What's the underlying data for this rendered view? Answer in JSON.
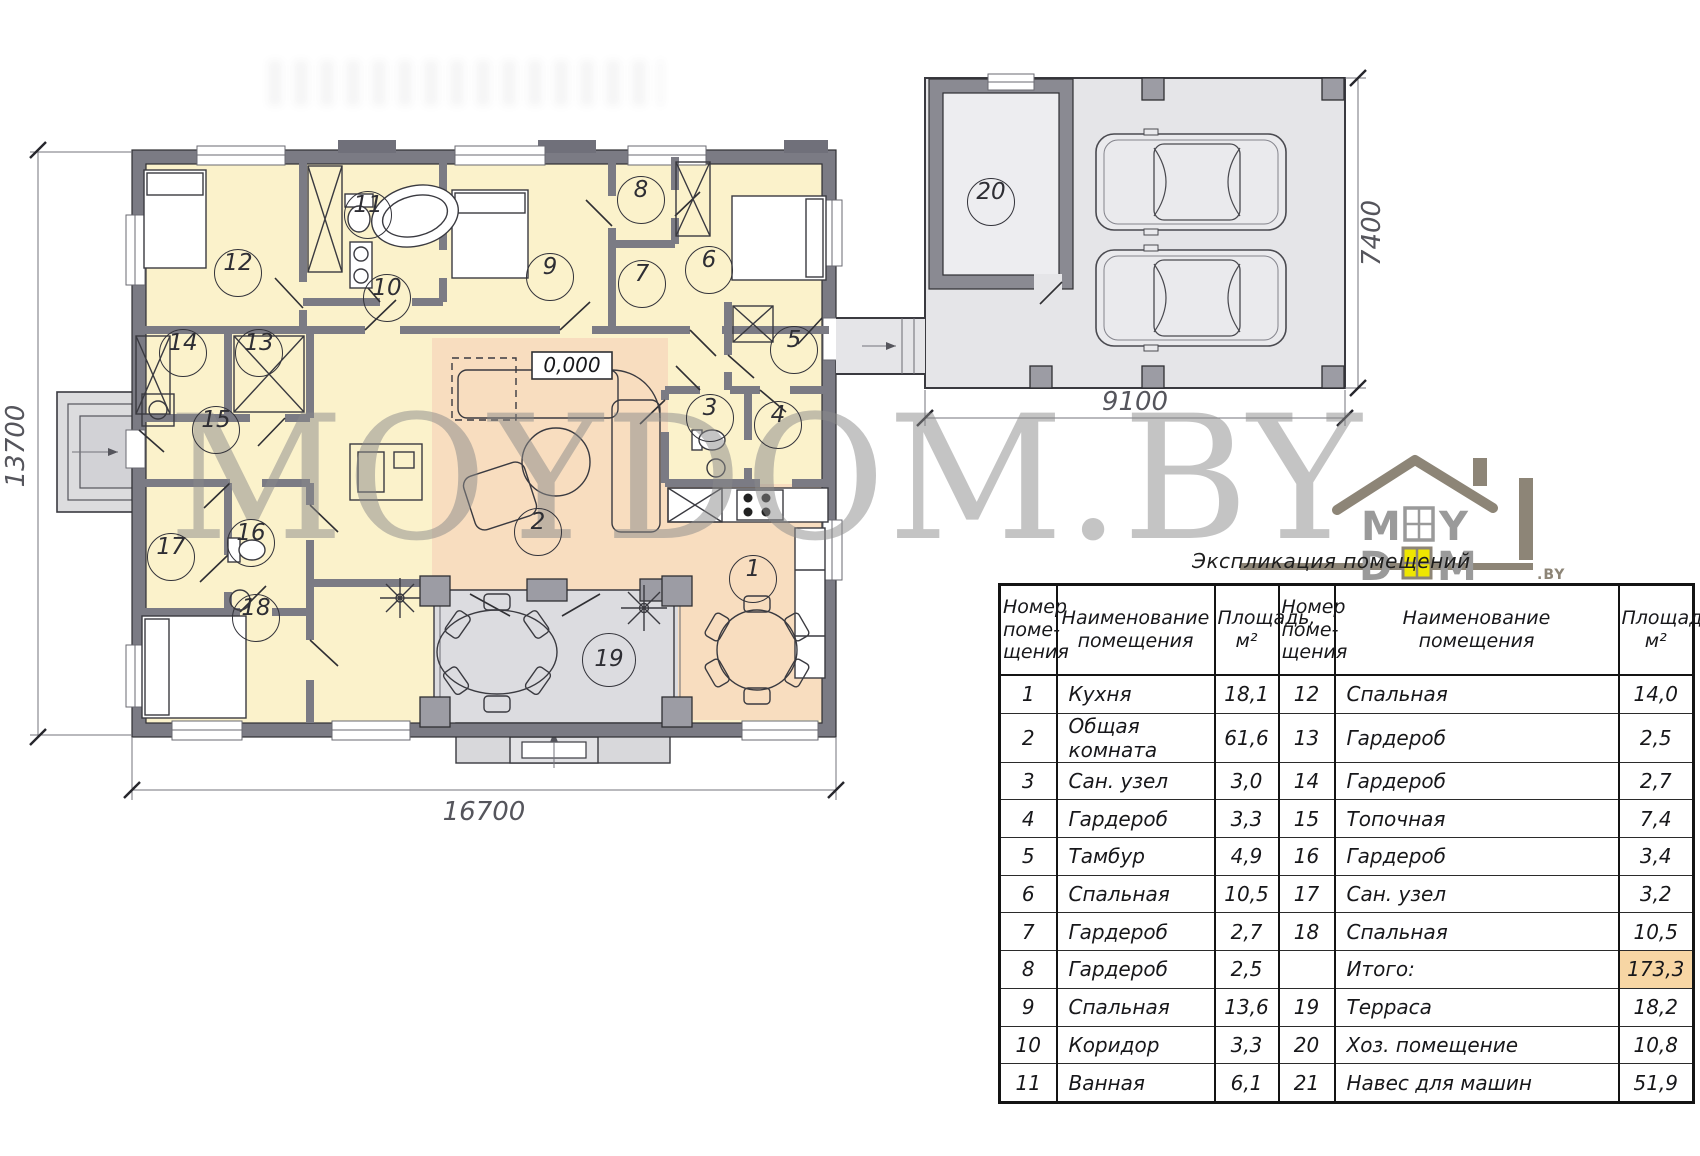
{
  "watermark": {
    "text": "MOYDOM.BY"
  },
  "logo": {
    "word_top": "MOY",
    "word_bottom": "DOM",
    "tld": ".BY",
    "house_color": "#8d8577",
    "window_color": "#efe600"
  },
  "plan": {
    "level_mark": "0,000",
    "dimensions": {
      "house_height": "13700",
      "house_width": "16700",
      "garage_width": "9100",
      "garage_height": "7400"
    },
    "rooms": {
      "r1": "1",
      "r2": "2",
      "r3": "3",
      "r4": "4",
      "r5": "5",
      "r6": "6",
      "r7": "7",
      "r8": "8",
      "r9": "9",
      "r10": "10",
      "r11": "11",
      "r12": "12",
      "r13": "13",
      "r14": "14",
      "r15": "15",
      "r16": "16",
      "r17": "17",
      "r18": "18",
      "r19": "19",
      "r20": "20"
    },
    "colors": {
      "room_fill": "#fbf2cb",
      "living_fill": "#f8ddbf",
      "terrace_fill": "#dcdce0",
      "wall": "#7b7b84",
      "carport_fill": "#e5e5e8",
      "total_highlight": "#f7d6a4"
    }
  },
  "table": {
    "title": "Экспликация помещений",
    "headers": {
      "num": "Номер\nпоме-\nщения",
      "name": "Наименование\nпомещения",
      "area": "Площадь,\nм²"
    },
    "rows": [
      {
        "ln": "1",
        "lname": "Кухня",
        "larea": "18,1",
        "rn": "12",
        "rname": "Спальная",
        "rarea": "14,0"
      },
      {
        "ln": "2",
        "lname": "Общая комната",
        "larea": "61,6",
        "rn": "13",
        "rname": "Гардероб",
        "rarea": "2,5"
      },
      {
        "ln": "3",
        "lname": "Сан. узел",
        "larea": "3,0",
        "rn": "14",
        "rname": "Гардероб",
        "rarea": "2,7"
      },
      {
        "ln": "4",
        "lname": "Гардероб",
        "larea": "3,3",
        "rn": "15",
        "rname": "Топочная",
        "rarea": "7,4"
      },
      {
        "ln": "5",
        "lname": "Тамбур",
        "larea": "4,9",
        "rn": "16",
        "rname": "Гардероб",
        "rarea": "3,4"
      },
      {
        "ln": "6",
        "lname": "Спальная",
        "larea": "10,5",
        "rn": "17",
        "rname": "Сан. узел",
        "rarea": "3,2"
      },
      {
        "ln": "7",
        "lname": "Гардероб",
        "larea": "2,7",
        "rn": "18",
        "rname": "Спальная",
        "rarea": "10,5"
      },
      {
        "ln": "8",
        "lname": "Гардероб",
        "larea": "2,5",
        "rn": "",
        "rname": "Итого:",
        "rarea": "173,3",
        "highlight": true
      },
      {
        "ln": "9",
        "lname": "Спальная",
        "larea": "13,6",
        "rn": "19",
        "rname": "Терраса",
        "rarea": "18,2"
      },
      {
        "ln": "10",
        "lname": "Коридор",
        "larea": "3,3",
        "rn": "20",
        "rname": "Хоз. помещение",
        "rarea": "10,8"
      },
      {
        "ln": "11",
        "lname": "Ванная",
        "larea": "6,1",
        "rn": "21",
        "rname": "Навес для машин",
        "rarea": "51,9"
      }
    ]
  }
}
